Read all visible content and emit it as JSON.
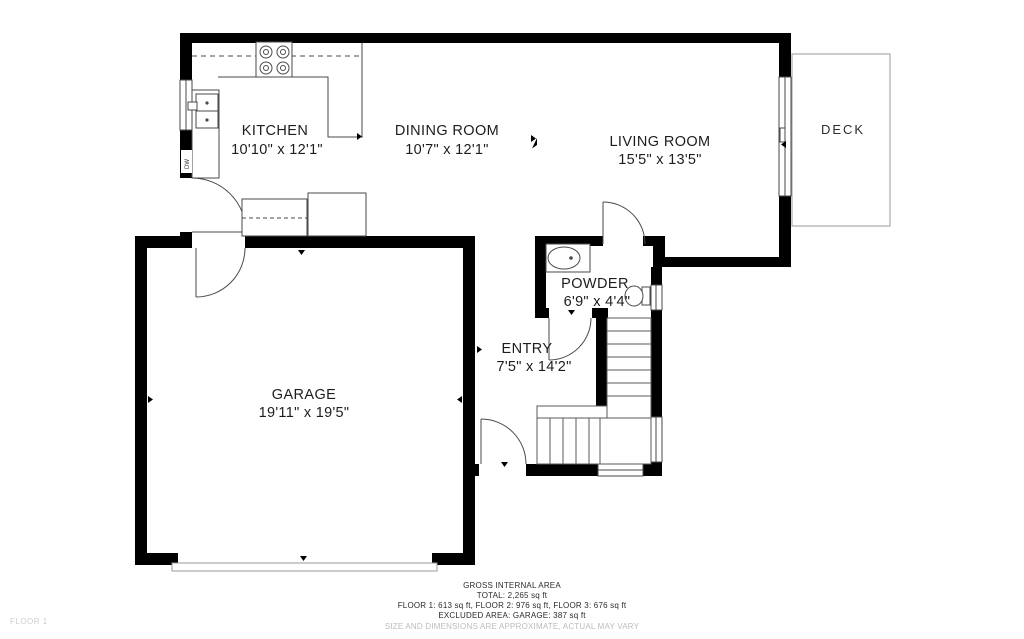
{
  "floor_plan": {
    "floor_label": "FLOOR 1",
    "rooms": {
      "kitchen": {
        "name": "KITCHEN",
        "dims": "10'10\" x 12'1\""
      },
      "dining": {
        "name": "DINING ROOM",
        "dims": "10'7\" x 12'1\""
      },
      "living": {
        "name": "LIVING ROOM",
        "dims": "15'5\" x 13'5\""
      },
      "deck": {
        "name": "DECK"
      },
      "powder": {
        "name": "POWDER",
        "dims": "6'9\" x 4'4\""
      },
      "entry": {
        "name": "ENTRY",
        "dims": "7'5\" x 14'2\""
      },
      "garage": {
        "name": "GARAGE",
        "dims": "19'11\" x 19'5\""
      }
    },
    "fixtures": {
      "dishwasher_label": "DW"
    },
    "footer": {
      "line1": "GROSS INTERNAL AREA",
      "line2": "TOTAL: 2,265 sq ft",
      "line3": "FLOOR 1: 613 sq ft, FLOOR 2: 976 sq ft, FLOOR 3: 676 sq ft",
      "line4": "EXCLUDED AREA: GARAGE: 387 sq ft",
      "line5": "SIZE AND DIMENSIONS ARE APPROXIMATE, ACTUAL MAY VARY"
    },
    "colors": {
      "wall": "#000000",
      "thin_line": "#4a4a4a",
      "muted_text": "#bcbcbc"
    }
  }
}
